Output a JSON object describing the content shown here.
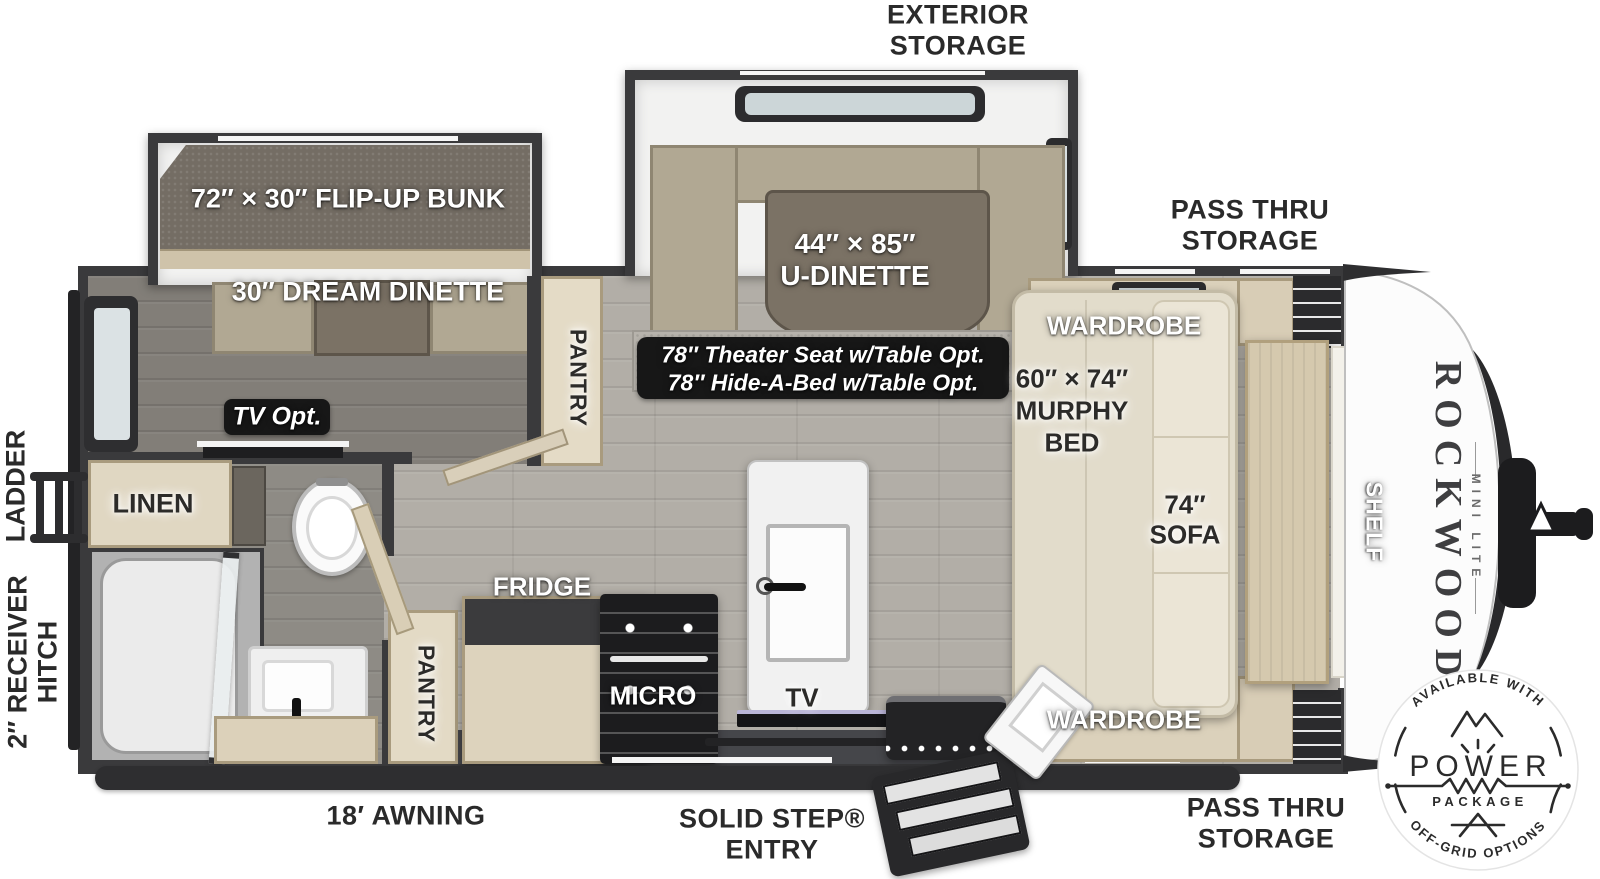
{
  "title": "Rockwood Mini Lite travel trailer floorplan",
  "labels": {
    "exterior_storage_1": "EXTERIOR",
    "exterior_storage_2": "STORAGE",
    "pass_thru_top_1": "PASS THRU",
    "pass_thru_top_2": "STORAGE",
    "pass_thru_bottom_1": "PASS THRU",
    "pass_thru_bottom_2": "STORAGE",
    "flip_up_bunk": "72″ × 30″ FLIP-UP BUNK",
    "dream_dinette": "30″ DREAM DINETTE",
    "u_dinette_1": "44″ × 85″",
    "u_dinette_2": "U-DINETTE",
    "theater_1": "78″ Theater Seat w/Table Opt.",
    "theater_2": "78″ Hide-A-Bed w/Table Opt.",
    "wardrobe_top": "WARDROBE",
    "wardrobe_bottom": "WARDROBE",
    "murphy_1": "60″ × 74″",
    "murphy_2": "MURPHY",
    "murphy_3": "BED",
    "sofa_1": "74″",
    "sofa_2": "SOFA",
    "shelf": "SHELF",
    "tv_opt": "TV Opt.",
    "tv": "TV",
    "micro": "MICRO",
    "fridge": "FRIDGE",
    "pantry_rear": "PANTRY",
    "pantry_kitchen": "PANTRY",
    "linen": "LINEN",
    "ladder": "LADDER",
    "receiver_1": "2″ RECEIVER",
    "receiver_2": "HITCH",
    "awning": "18′ AWNING",
    "entry_1": "SOLID STEP®",
    "entry_2": "ENTRY"
  },
  "brand": {
    "name": "ROCKWOOD",
    "model": "MINI LITE"
  },
  "badge": {
    "arc_top": "AVAILABLE WITH",
    "power": "POWER",
    "package": "PACKAGE",
    "arc_bottom": "OFF-GRID OPTIONS"
  },
  "colors": {
    "wall": "#3a3a3c",
    "floor_main": "#b2aea7",
    "floor_rear": "#827e78",
    "cabinet_beige": "#d8cdb6",
    "cushion_tan": "#b1a893",
    "table_brown": "#7b7265",
    "label_white": "#ffffff",
    "label_dark": "#2c2b29",
    "badge_ink": "#2b2b2b"
  }
}
